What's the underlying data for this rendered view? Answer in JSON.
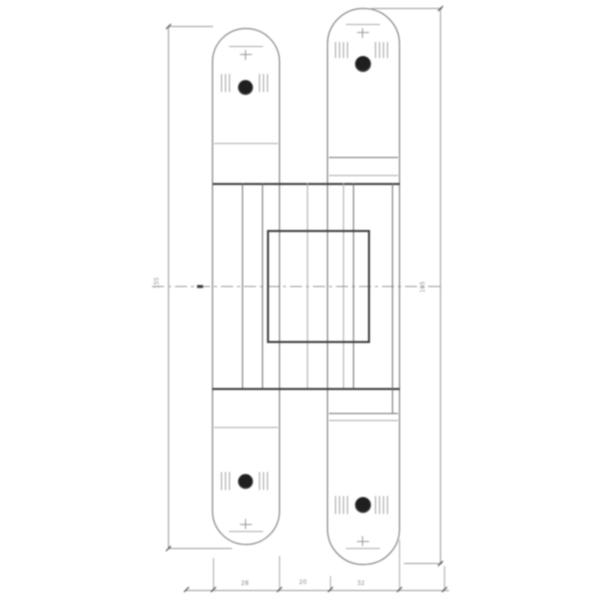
{
  "drawing_type": "concealed-hinge-technical-drawing",
  "dim_labels": {
    "left_height": "155",
    "right_height": "165",
    "bottom_left": "28",
    "bottom_mid": "20",
    "bottom_right": "32"
  },
  "symbols": {
    "screw_head": "filled-circle",
    "countersunk_hole": "cross-with-bar",
    "knurl_marks": "short-vertical-hatch",
    "center_axis": "dash-dot-line"
  },
  "colors": {
    "background": "#ffffff",
    "line": "#6b6b6b",
    "line_dark": "#3a3a3a",
    "line_light": "#a9a9a9",
    "dim": "#979797",
    "dim_text": "#8a8a8a",
    "screw": "#1f1f1f"
  }
}
